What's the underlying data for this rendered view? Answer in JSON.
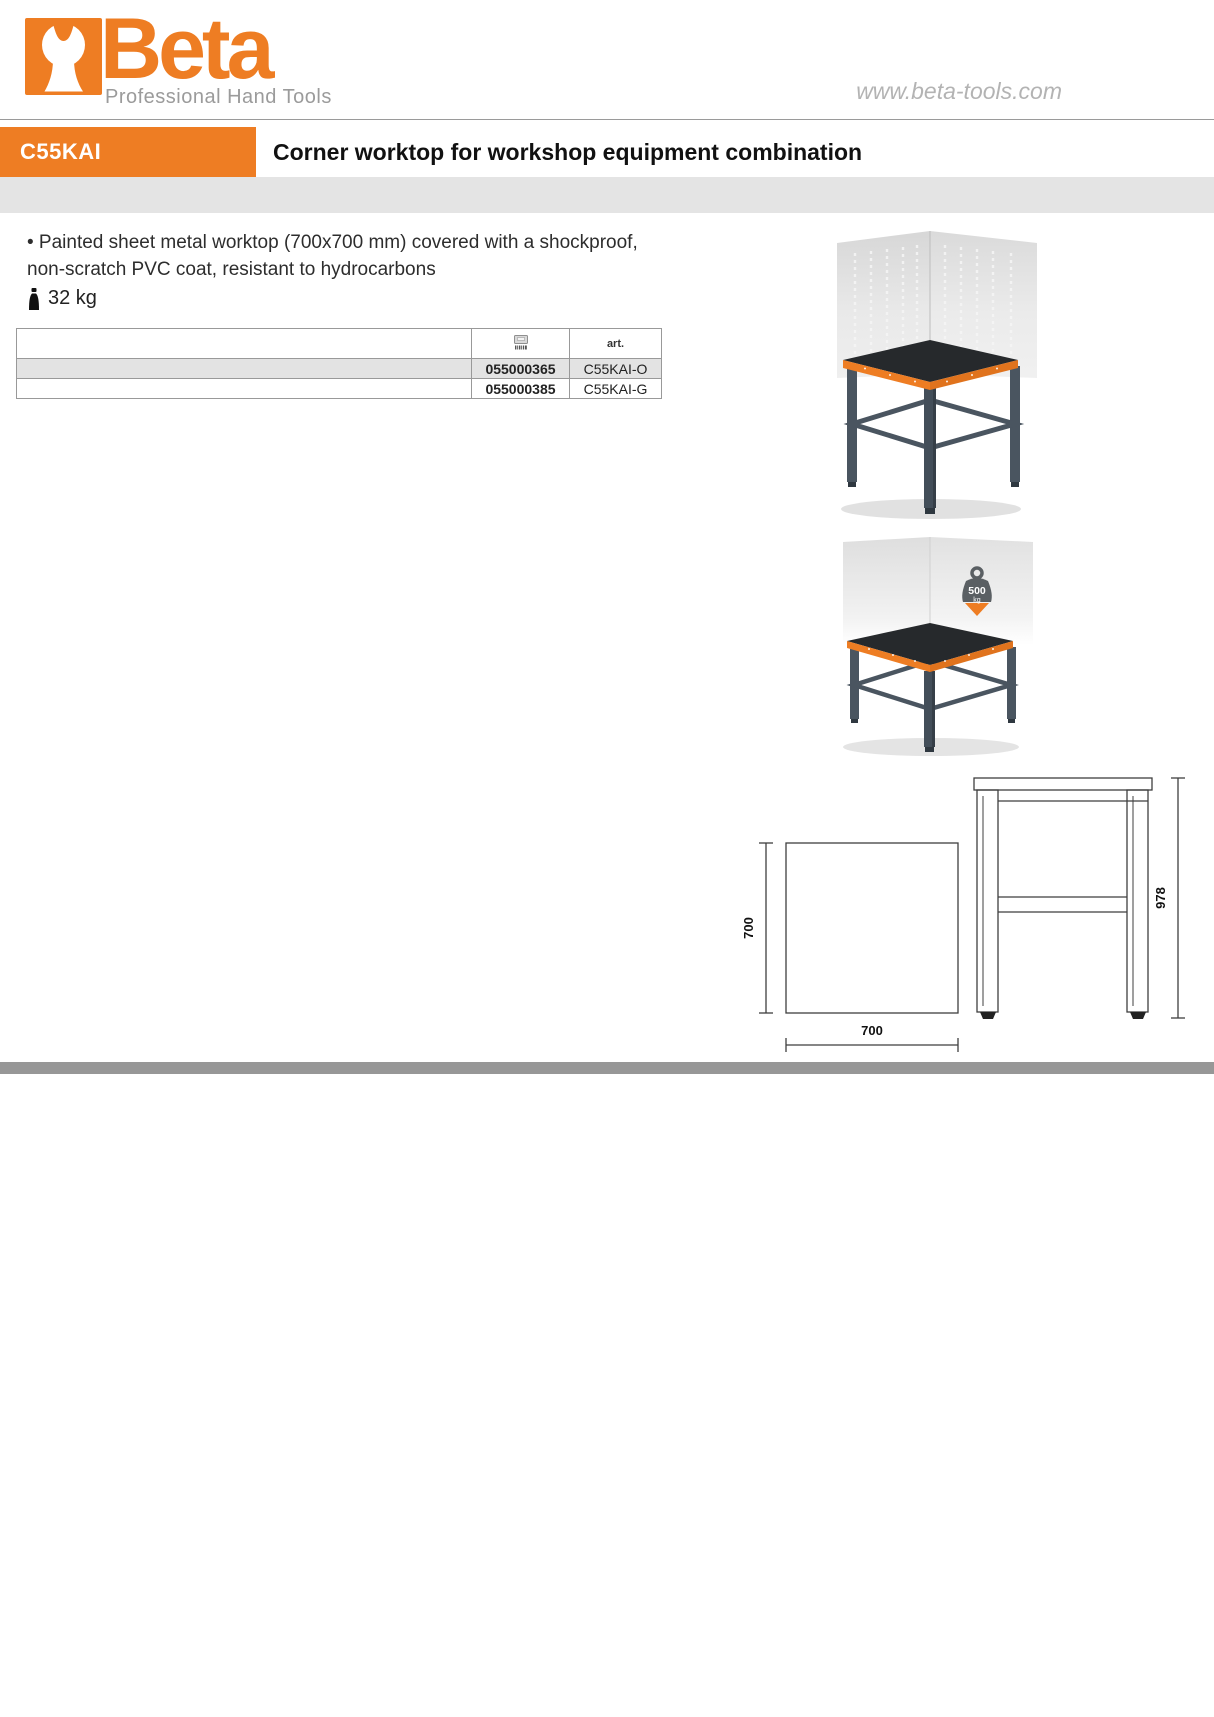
{
  "brand": {
    "name": "Beta",
    "tagline": "Professional Hand Tools",
    "website": "www.beta-tools.com"
  },
  "header": {
    "product_code": "C55KAI",
    "title": "Corner worktop for workshop equipment combination"
  },
  "description": {
    "line1": "• Painted sheet metal worktop (700x700 mm) covered with a shockproof,",
    "line2": "non-scratch PVC coat, resistant to hydrocarbons",
    "weight": "32 kg"
  },
  "order_table": {
    "col_code_icon": "barcode-icon",
    "col_art": "art.",
    "rows": [
      {
        "code": "055000365",
        "art": "C55KAI-O"
      },
      {
        "code": "055000385",
        "art": "C55KAI-G"
      }
    ]
  },
  "capacity_badge": {
    "value": "500",
    "unit": "kg"
  },
  "drawing": {
    "depth_label": "700",
    "width_label": "700",
    "height_label": "978"
  },
  "colors": {
    "brand_orange": "#ee7d23",
    "header_band_gray": "#e4e4e4",
    "table_row_gray": "#e3e3e3",
    "footer_gray": "#979797",
    "leg_slate": "#4a5560",
    "worktop_black": "#26292c"
  }
}
